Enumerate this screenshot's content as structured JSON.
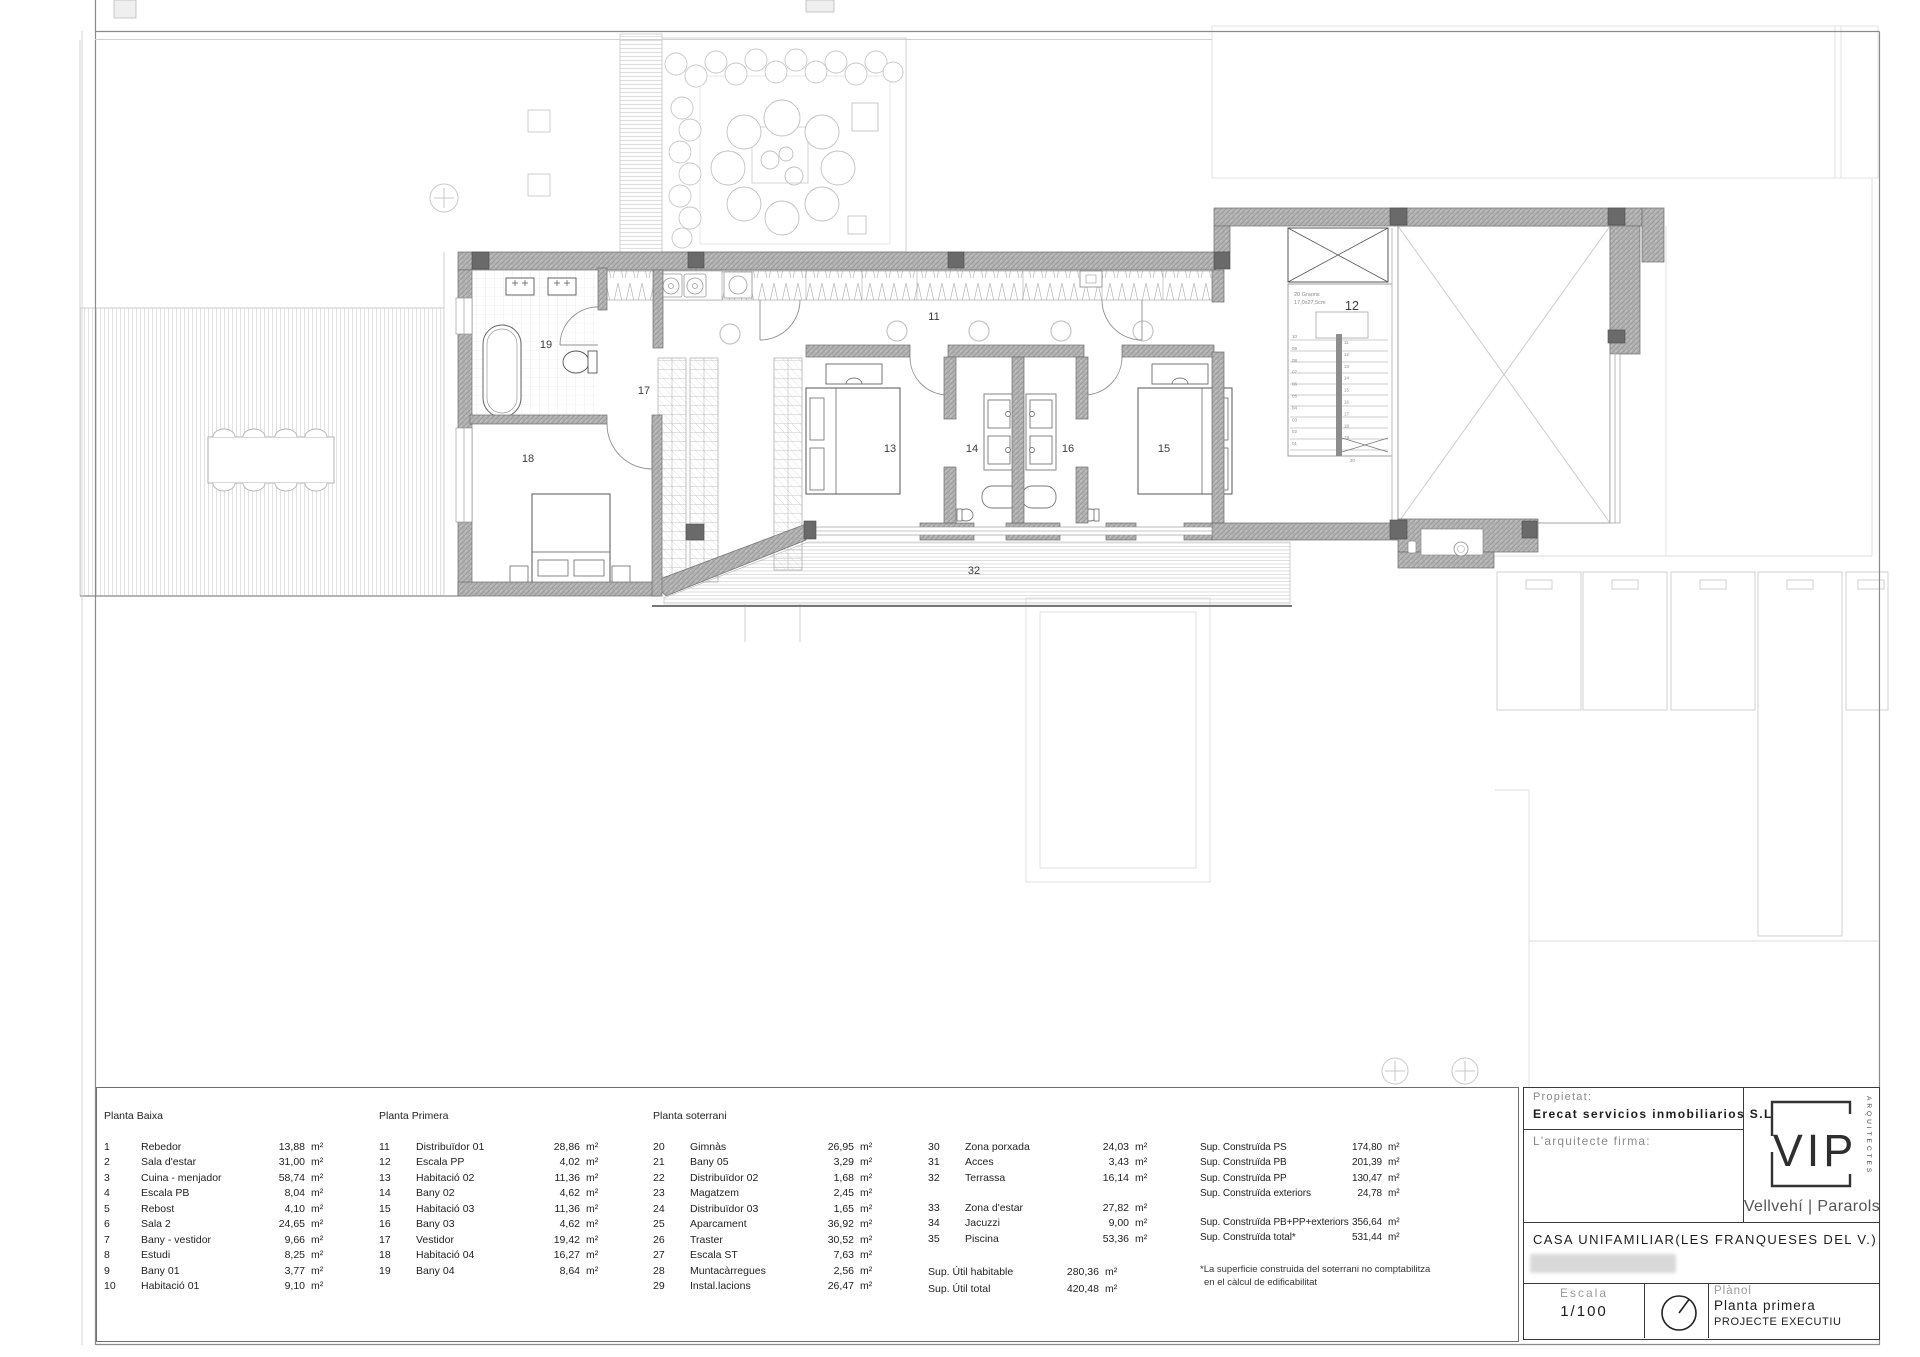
{
  "colors": {
    "wall_gray": "#b0b0b0",
    "line_dark": "#555555",
    "faint_gray": "#dddddd"
  },
  "plan": {
    "labels": {
      "r11": "11",
      "r12": "12",
      "r13": "13",
      "r14": "14",
      "r15": "15",
      "r16": "16",
      "r17": "17",
      "r18": "18",
      "r19": "19",
      "r32": "32"
    },
    "stair": {
      "note1": "20 Graons",
      "note2": "17,0x27,5cm",
      "left_treads": [
        "10",
        "09",
        "08",
        "07",
        "06",
        "05",
        "04",
        "03",
        "02",
        "01"
      ],
      "right_treads": [
        "11",
        "12",
        "13",
        "14",
        "15",
        "16",
        "17",
        "18",
        "19"
      ],
      "bottom": "20"
    }
  },
  "legend": {
    "col1": {
      "title": "Planta Baixa",
      "rows": [
        {
          "num": "1",
          "name": "Rebedor",
          "area": "13,88",
          "unit": "m²"
        },
        {
          "num": "2",
          "name": "Sala d'estar",
          "area": "31,00",
          "unit": "m²"
        },
        {
          "num": "3",
          "name": "Cuina - menjador",
          "area": "58,74",
          "unit": "m²"
        },
        {
          "num": "4",
          "name": "Escala PB",
          "area": "8,04",
          "unit": "m²"
        },
        {
          "num": "5",
          "name": "Rebost",
          "area": "4,10",
          "unit": "m²"
        },
        {
          "num": "6",
          "name": "Sala 2",
          "area": "24,65",
          "unit": "m²"
        },
        {
          "num": "7",
          "name": "Bany - vestidor",
          "area": "9,66",
          "unit": "m²"
        },
        {
          "num": "8",
          "name": "Estudi",
          "area": "8,25",
          "unit": "m²"
        },
        {
          "num": "9",
          "name": "Bany 01",
          "area": "3,77",
          "unit": "m²"
        },
        {
          "num": "10",
          "name": "Habitació 01",
          "area": "9,10",
          "unit": "m²"
        }
      ]
    },
    "col2": {
      "title": "Planta Primera",
      "rows": [
        {
          "num": "11",
          "name": "Distribuïdor 01",
          "area": "28,86",
          "unit": "m²"
        },
        {
          "num": "12",
          "name": "Escala PP",
          "area": "4,02",
          "unit": "m²"
        },
        {
          "num": "13",
          "name": "Habitació 02",
          "area": "11,36",
          "unit": "m²"
        },
        {
          "num": "14",
          "name": "Bany 02",
          "area": "4,62",
          "unit": "m²"
        },
        {
          "num": "15",
          "name": "Habitació 03",
          "area": "11,36",
          "unit": "m²"
        },
        {
          "num": "16",
          "name": "Bany 03",
          "area": "4,62",
          "unit": "m²"
        },
        {
          "num": "17",
          "name": "Vestidor",
          "area": "19,42",
          "unit": "m²"
        },
        {
          "num": "18",
          "name": "Habitació 04",
          "area": "16,27",
          "unit": "m²"
        },
        {
          "num": "19",
          "name": "Bany 04",
          "area": "8,64",
          "unit": "m²"
        }
      ]
    },
    "col3": {
      "title": "Planta soterrani",
      "rows": [
        {
          "num": "20",
          "name": "Gimnàs",
          "area": "26,95",
          "unit": "m²"
        },
        {
          "num": "21",
          "name": "Bany 05",
          "area": "3,29",
          "unit": "m²"
        },
        {
          "num": "22",
          "name": "Distribuïdor 02",
          "area": "1,68",
          "unit": "m²"
        },
        {
          "num": "23",
          "name": "Magatzem",
          "area": "2,45",
          "unit": "m²"
        },
        {
          "num": "24",
          "name": "Distribuïdor 03",
          "area": "1,65",
          "unit": "m²"
        },
        {
          "num": "25",
          "name": "Aparcament",
          "area": "36,92",
          "unit": "m²"
        },
        {
          "num": "26",
          "name": "Traster",
          "area": "30,52",
          "unit": "m²"
        },
        {
          "num": "27",
          "name": "Escala ST",
          "area": "7,63",
          "unit": "m²"
        },
        {
          "num": "28",
          "name": "Muntacàrregues",
          "area": "2,56",
          "unit": "m²"
        },
        {
          "num": "29",
          "name": "Instal.lacions",
          "area": "26,47",
          "unit": "m²"
        }
      ]
    },
    "col4a": {
      "rows": [
        {
          "num": "30",
          "name": "Zona porxada",
          "area": "24,03",
          "unit": "m²"
        },
        {
          "num": "31",
          "name": "Acces",
          "area": "3,43",
          "unit": "m²"
        },
        {
          "num": "32",
          "name": "Terrassa",
          "area": "16,14",
          "unit": "m²"
        }
      ]
    },
    "col4b": {
      "rows": [
        {
          "num": "33",
          "name": "Zona d'estar",
          "area": "27,82",
          "unit": "m²"
        },
        {
          "num": "34",
          "name": "Jacuzzi",
          "area": "9,00",
          "unit": "m²"
        },
        {
          "num": "35",
          "name": "Piscina",
          "area": "53,36",
          "unit": "m²"
        }
      ]
    },
    "col4_totals": {
      "rows": [
        {
          "name": "Sup. Útil habitable",
          "area": "280,36",
          "unit": "m²"
        },
        {
          "name": "Sup. Útil total",
          "area": "420,48",
          "unit": "m²"
        }
      ]
    },
    "col5a": {
      "rows": [
        {
          "num": "",
          "name": "Sup. Construïda PS",
          "area": "174,80",
          "unit": "m²"
        },
        {
          "num": "",
          "name": "Sup. Construïda PB",
          "area": "201,39",
          "unit": "m²"
        },
        {
          "num": "",
          "name": "Sup. Construïda PP",
          "area": "130,47",
          "unit": "m²"
        },
        {
          "num": "",
          "name": "Sup. Construïda exteriors",
          "area": "24,78",
          "unit": "m²"
        }
      ]
    },
    "col5b": {
      "rows": [
        {
          "num": "",
          "name": "Sup. Construïda PB+PP+exteriors",
          "area": "356,64",
          "unit": "m²"
        },
        {
          "num": "",
          "name": "Sup. Construïda total*",
          "area": "531,44",
          "unit": "m²"
        }
      ]
    },
    "footnote1": "*La superficie construida del soterrani no comptabilitza",
    "footnote2": "en el càlcul de edificabilitat"
  },
  "title_block": {
    "propietat_label": "Propietat:",
    "propietat_value": "Erecat servicios inmobiliarios S.L",
    "arquitecte_label": "L'arquitecte firma:",
    "logo_text": "VIP",
    "logo_vertical": "ARQUITECTES",
    "logo_sub": "Vellvehí | Pararols",
    "project_title": "CASA UNIFAMILIAR(LES FRANQUESES DEL V.)",
    "escala_label": "Escala",
    "escala_value": "1/100",
    "planol_label": "Plànol",
    "planol_value": "Planta primera",
    "planol_sub": "PROJECTE EXECUTIU"
  }
}
